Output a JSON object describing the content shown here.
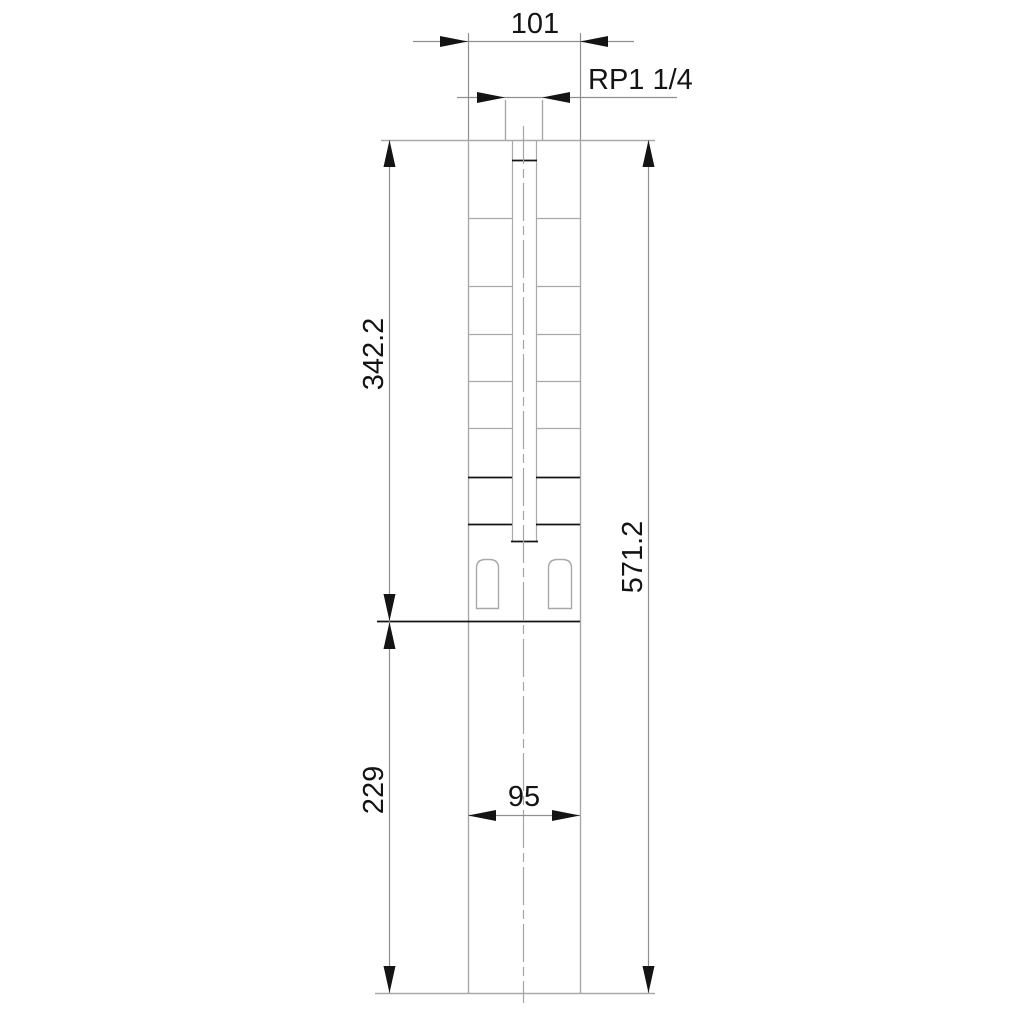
{
  "drawing": {
    "kind": "technical-dimensional-drawing",
    "subject": "submersible-borehole-pump-outline",
    "dimension_labels": {
      "outlet_width": "101",
      "thread_connection": "RP1 1/4",
      "pump_section_length": "342.2",
      "total_length": "571.2",
      "motor_section_length": "229",
      "motor_width": "95"
    },
    "colors": {
      "background": "#ffffff",
      "body_outline": "#a9a9a9",
      "dimension_lines": "#8f8f8f",
      "emphasis_lines": "#141414",
      "text": "#141414"
    }
  }
}
